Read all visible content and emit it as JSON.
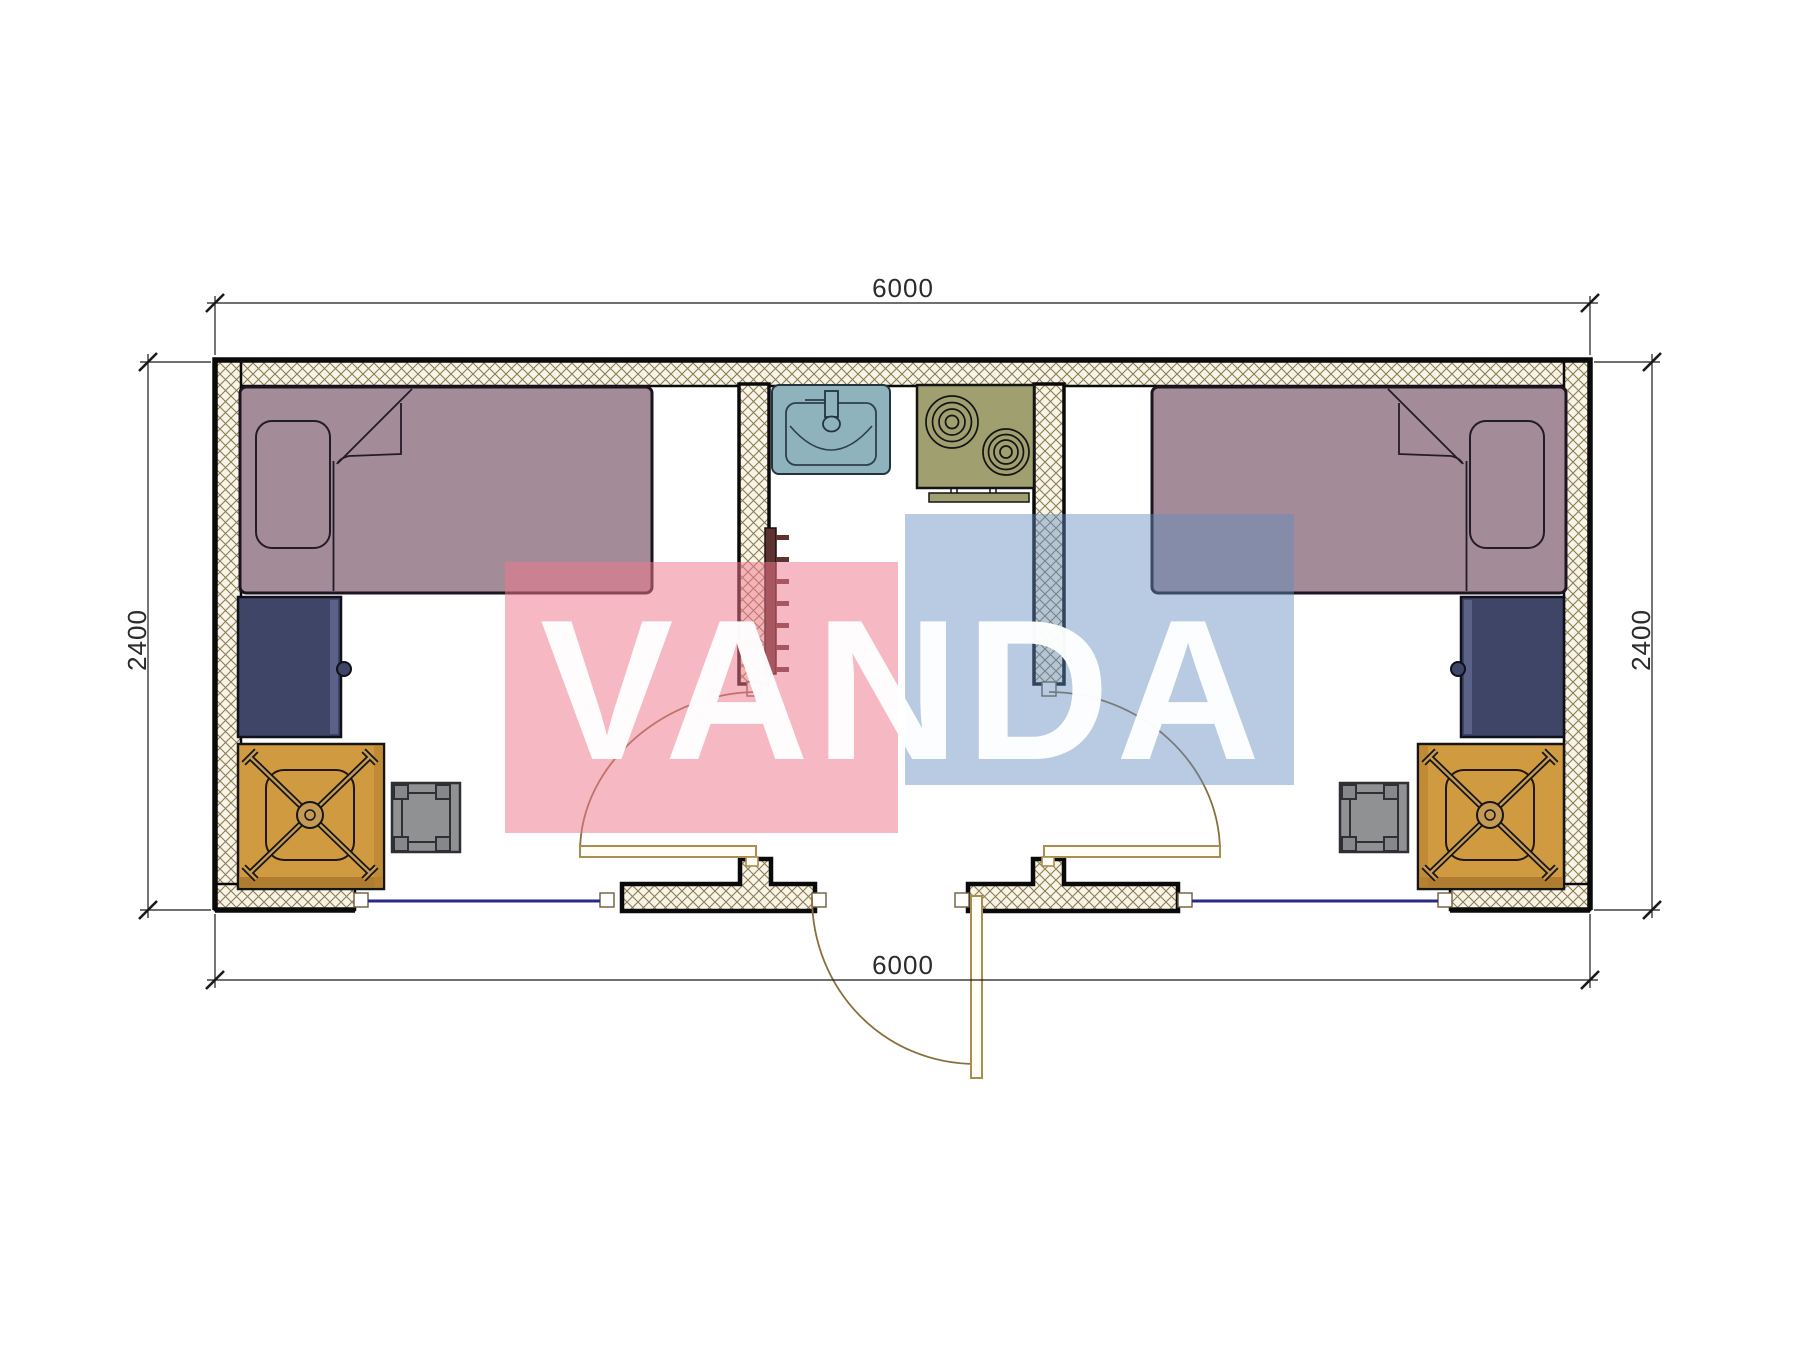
{
  "page": {
    "type": "architectural floor plan drawing of a 6000x2400 modular cabin with two bedrooms and central kitchen/bath"
  },
  "dimensions": {
    "top": "6000",
    "bottom": "6000",
    "left": "2400",
    "right": "2400"
  },
  "watermark": {
    "text": "VANDA",
    "pink_color": "#ee768c",
    "blue_color": "#628cbf",
    "text_color": "#ffffff"
  },
  "colors": {
    "wall_hatch_line": "#8d7c52",
    "wall_fill": "#f8f4e8",
    "outline_black": "#0a0a0a",
    "bed_mauve": "#a38c98",
    "cabinet_navy": "#3f4566",
    "desk_orange": "#d09b40",
    "chair_tan": "#c49a55",
    "stool_gray": "#8f9193",
    "sink_teal": "#8fb3bd",
    "stove_olive": "#9f9f70",
    "radiator_brown": "#5c3330",
    "door_leaf_tan": "#a98e4f",
    "door_swing_arc": "#8a6f3e",
    "window_line_navy": "#2a2a85",
    "dimension_text": "#2b2b2b"
  },
  "rooms": {
    "left_bedroom": {
      "items": [
        "single-bed",
        "pillow",
        "navy-cabinet",
        "orange-desk",
        "office-chair",
        "stool"
      ]
    },
    "center_kitchen_bath": {
      "items": [
        "sink",
        "two-burner-stove",
        "radiator"
      ]
    },
    "right_bedroom": {
      "items": [
        "single-bed",
        "pillow",
        "navy-cabinet",
        "orange-desk",
        "office-chair",
        "stool"
      ]
    }
  },
  "openings": {
    "interior_doors": 2,
    "exterior_door": 1,
    "windows": 2
  }
}
